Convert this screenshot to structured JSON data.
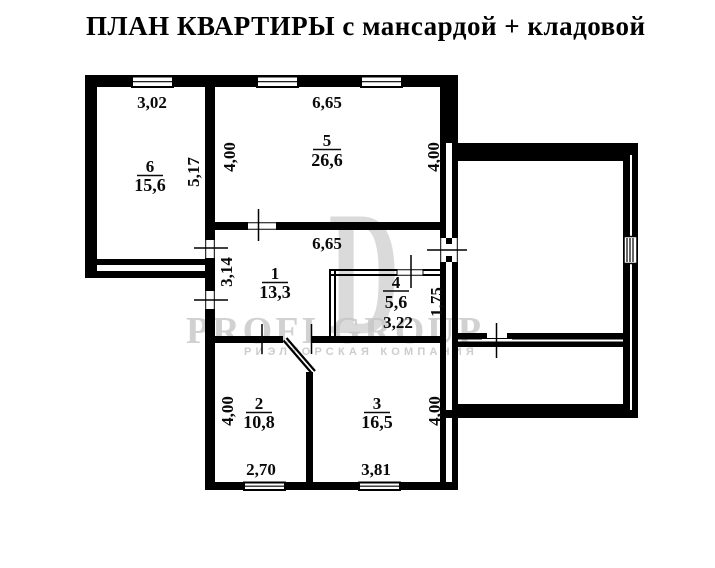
{
  "title": "ПЛАН КВАРТИРЫ с мансардой + кладовой",
  "watermark": {
    "logo_glyph": "D",
    "brand": "PROFI GROUP",
    "tagline": "РИЭЛТОРСКАЯ КОМПАНИЯ"
  },
  "rooms": {
    "r1": {
      "number": "1",
      "area": "13,3"
    },
    "r2": {
      "number": "2",
      "area": "10,8"
    },
    "r3": {
      "number": "3",
      "area": "16,5"
    },
    "r4": {
      "number": "4",
      "area": "5,6"
    },
    "r5": {
      "number": "5",
      "area": "26,6"
    },
    "r6": {
      "number": "6",
      "area": "15,6"
    }
  },
  "dimensions": {
    "room6_width_top": "3,02",
    "room6_height_side": "5,17",
    "room5_width_top": "6,65",
    "room5_height_left": "4,00",
    "room5_height_right": "4,00",
    "room1_width": "6,65",
    "room1_height_left": "3,14",
    "room4_width": "3,22",
    "room4_height_right": "1,75",
    "room2_height_left": "4,00",
    "room2_width_bottom": "2,70",
    "room3_width_bottom": "3,81",
    "room3_height_right": "4,00"
  },
  "colors": {
    "wall": "#000000",
    "watermark_gray": "#c6c6c6",
    "background": "#ffffff"
  }
}
